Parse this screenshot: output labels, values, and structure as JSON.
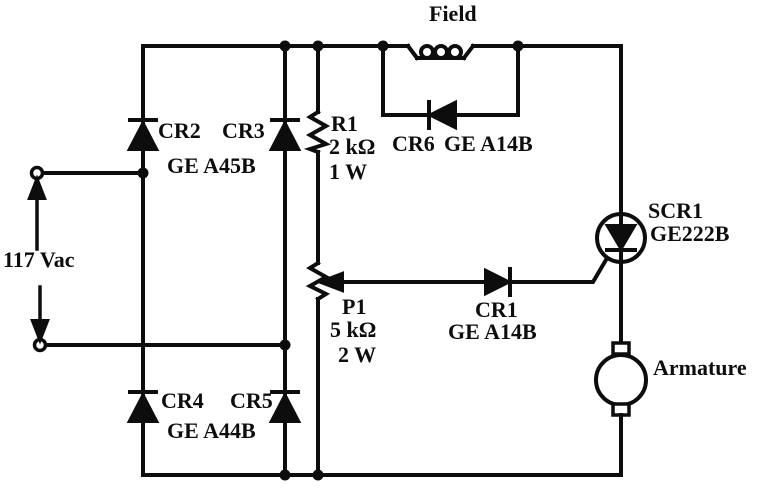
{
  "figure": {
    "type": "circuit-schematic",
    "background_color": "#ffffff",
    "ink_color": "#0d0d0d"
  },
  "source": {
    "label": "117 Vac"
  },
  "field_winding": {
    "label": "Field"
  },
  "armature": {
    "label": "Armature"
  },
  "bridge": {
    "cr2": "CR2",
    "cr3": "CR3",
    "top_part": "GE A45B",
    "cr4": "CR4",
    "cr5": "CR5",
    "bottom_part": "GE A44B"
  },
  "r1": {
    "name": "R1",
    "value": "2 kΩ",
    "power": "1 W"
  },
  "p1": {
    "name": "P1",
    "value": "5 kΩ",
    "power": "2 W"
  },
  "cr6": {
    "name": "CR6",
    "part": "GE A14B"
  },
  "cr1": {
    "name": "CR1",
    "part": "GE A14B"
  },
  "scr1": {
    "name": "SCR1",
    "part": "GE222B"
  }
}
